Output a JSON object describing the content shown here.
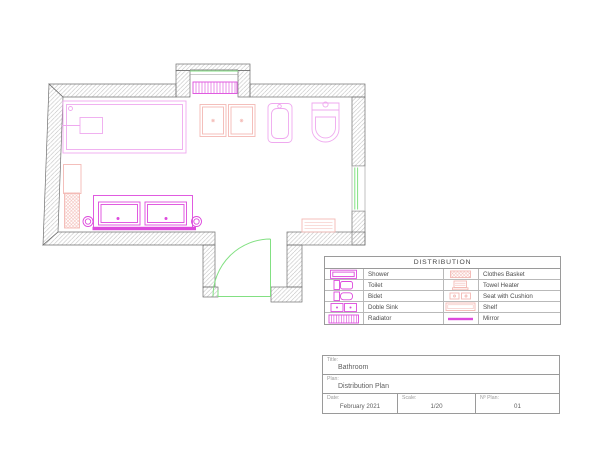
{
  "colors": {
    "magenta": "#dd4add",
    "magenta_light": "#efa9ef",
    "pink": "#f3b9b4",
    "green": "#82e082",
    "wall": "#707070",
    "hatch": "#b9b9b9",
    "border": "#9a9a9a",
    "text": "#5f5f5f",
    "text_light": "#9b9b9b"
  },
  "legend": {
    "title": "DISTRIBUTION",
    "rows": [
      {
        "left_icon": "shower-icon",
        "left_label": "Shower",
        "right_icon": "clothes-basket-icon",
        "right_label": "Clothes Basket"
      },
      {
        "left_icon": "toilet-icon",
        "left_label": "Toilet",
        "right_icon": "towel-heater-icon",
        "right_label": "Towel Heater"
      },
      {
        "left_icon": "bidet-icon",
        "left_label": "Bidet",
        "right_icon": "seat-with-cushion-icon",
        "right_label": "Seat with Cushion"
      },
      {
        "left_icon": "double-sink-icon",
        "left_label": "Doble Sink",
        "right_icon": "shelf-icon",
        "right_label": "Shelf"
      },
      {
        "left_icon": "radiator-icon",
        "left_label": "Radiator",
        "right_icon": "mirror-icon",
        "right_label": "Mirror"
      }
    ]
  },
  "title_block": {
    "title_label": "Title:",
    "title_value": "Bathroom",
    "plan_label": "Plan:",
    "plan_value": "Distribution Plan",
    "date_label": "Date:",
    "date_value": "February 2021",
    "scale_label": "Scale:",
    "scale_value": "1/20",
    "nplan_label": "Nº Plan:",
    "nplan_value": "01"
  }
}
